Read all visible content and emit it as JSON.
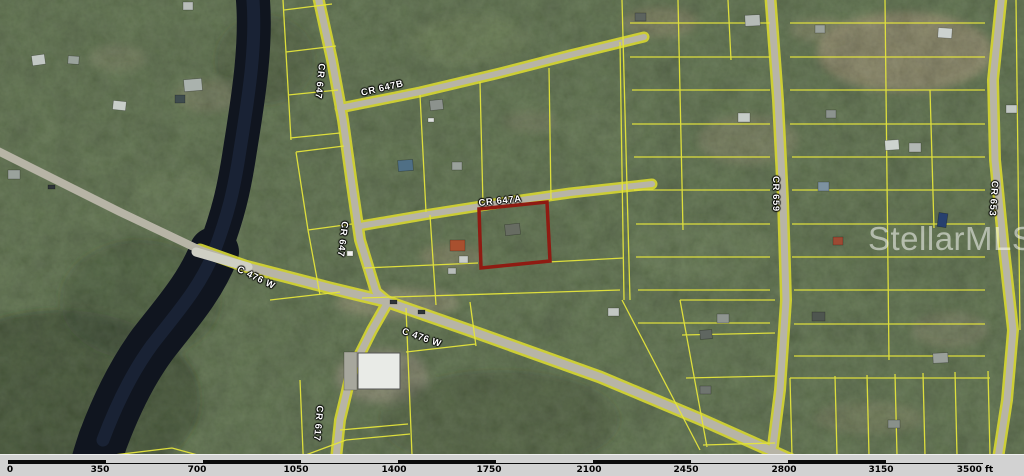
{
  "map": {
    "watermark_text": "StellarMLS",
    "labels": {
      "cr647_n": "CR 647",
      "cr647_s": "CR 647",
      "cr647b": "CR 647B",
      "cr647a": "CR 647A",
      "cr617": "CR 617",
      "cr659": "CR 659",
      "cr653": "CR 653",
      "c476w_w": "C 476 W",
      "c476w_e": "C 476 W"
    },
    "highlight_parcel": {
      "outline_color": "#8f1b12"
    },
    "colors": {
      "parcel_line": "#e4e43c",
      "road": "#b7b4a6",
      "water": "#10151f",
      "forest_base": "#5a7046",
      "scalebar_bg": "#d2d2d2"
    }
  },
  "scalebar": {
    "unit": "ft",
    "ticks": [
      "0",
      "350",
      "700",
      "1050",
      "1400",
      "1750",
      "2100",
      "2450",
      "2800",
      "3150",
      "3500 ft"
    ]
  }
}
